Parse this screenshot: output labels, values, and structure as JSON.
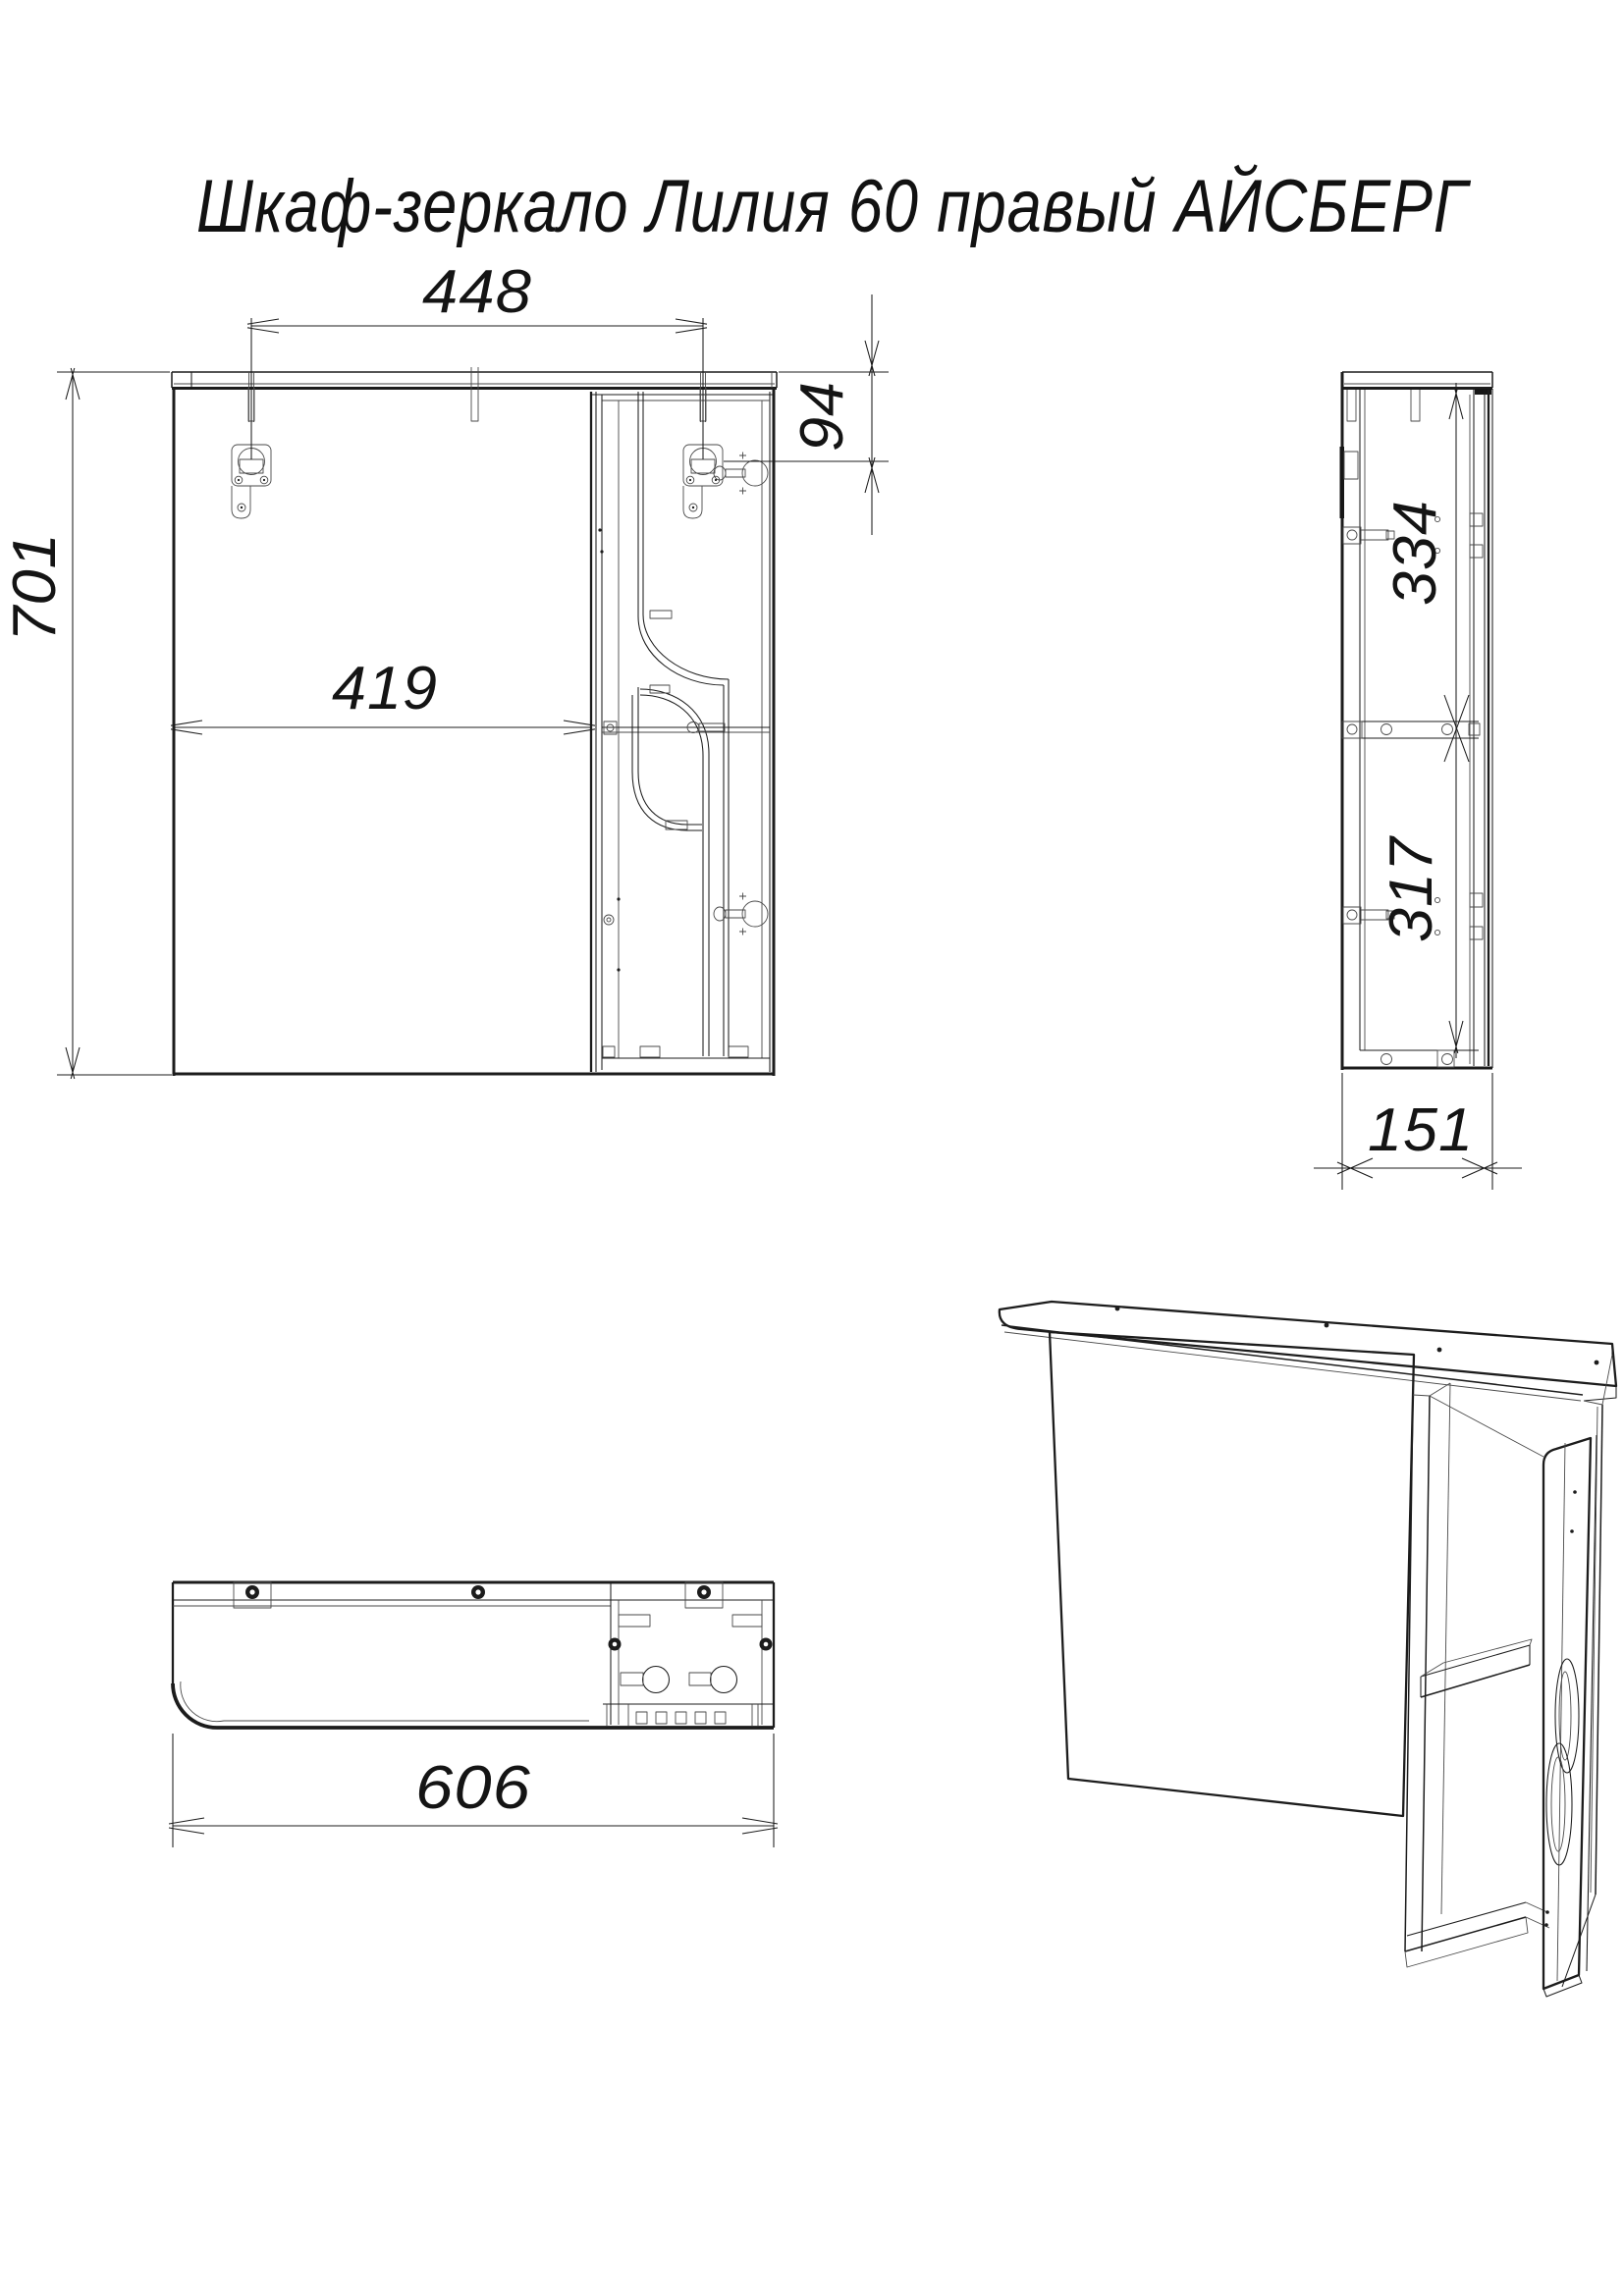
{
  "title": "Шкаф-зеркало Лилия 60 правый АЙСБЕРГ",
  "drawing": {
    "ink_color": "#1c1c1c",
    "paper_color": "#ffffff",
    "units": "mm"
  },
  "views": {
    "front": {
      "label": "front-view",
      "dims": {
        "mount_spacing": "448",
        "mount_offset": "94",
        "overall_height": "701",
        "door_width": "419"
      }
    },
    "side": {
      "label": "side-view",
      "dims": {
        "upper_section": "334",
        "lower_section": "317",
        "depth": "151"
      }
    },
    "bottom": {
      "label": "bottom-view",
      "dims": {
        "overall_width": "606"
      }
    },
    "perspective": {
      "label": "perspective-view"
    }
  }
}
